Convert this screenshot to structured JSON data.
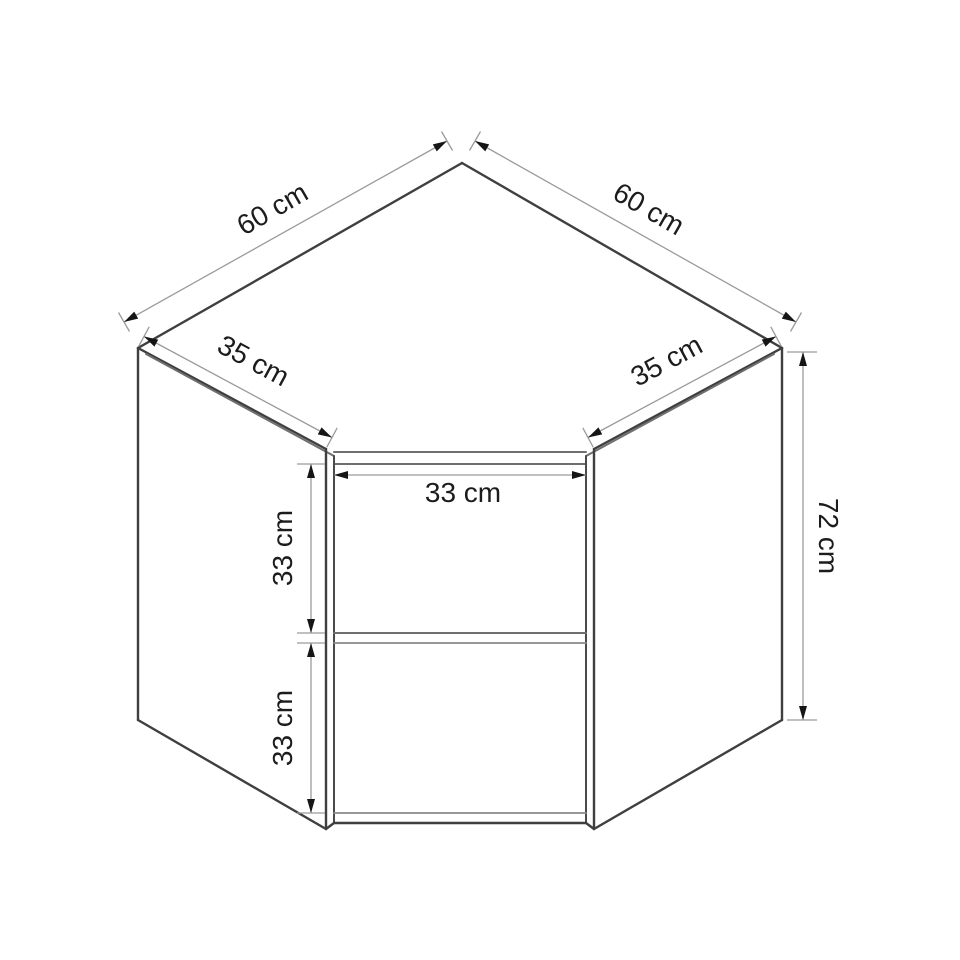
{
  "diagram": {
    "type": "dimension-drawing",
    "subject": "corner wall cabinet with open front and middle shelf",
    "unit": "cm",
    "dimensions": {
      "top_edge_left": {
        "label": "60 cm",
        "value": 60
      },
      "top_edge_right": {
        "label": "60 cm",
        "value": 60
      },
      "side_depth_left": {
        "label": "35 cm",
        "value": 35
      },
      "side_depth_right": {
        "label": "35 cm",
        "value": 35
      },
      "opening_width": {
        "label": "33 cm",
        "value": 33
      },
      "upper_compartment_height": {
        "label": "33 cm",
        "value": 33
      },
      "lower_compartment_height": {
        "label": "33 cm",
        "value": 33
      },
      "overall_height": {
        "label": "72 cm",
        "value": 72
      }
    },
    "colors": {
      "background": "#ffffff",
      "outline": "#3f3f3f",
      "inner_edge": "#6f6f6f",
      "dimension_line": "#9b9b9b",
      "arrow": "#151515",
      "label_text": "#1c1c1c"
    }
  }
}
